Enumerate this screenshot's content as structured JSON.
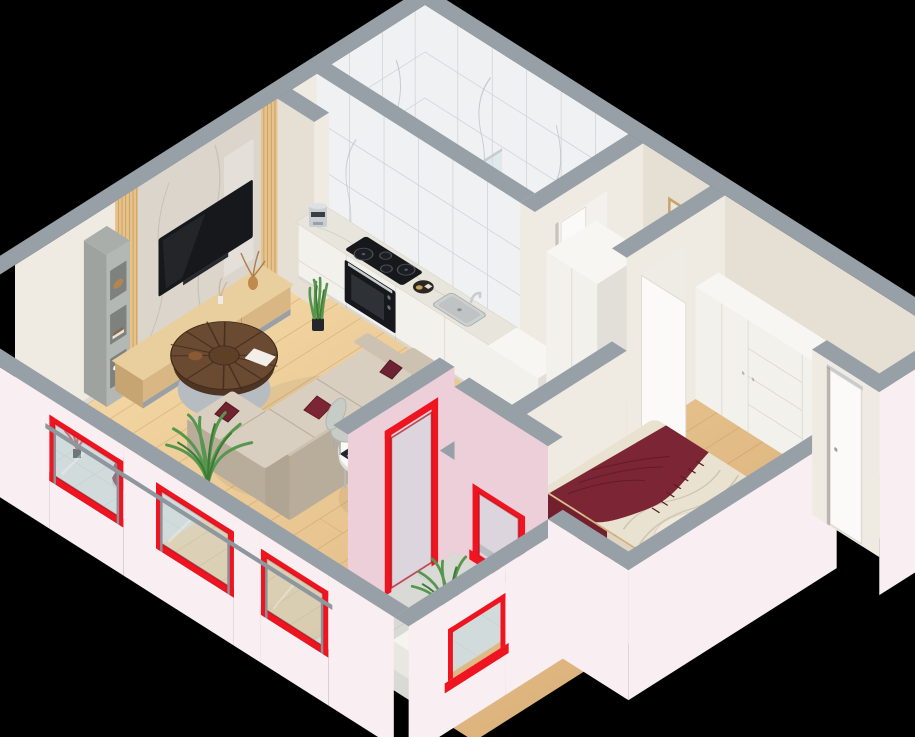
{
  "meta": {
    "type": "3d-floor-plan-render",
    "view": "isometric cutaway, viewed from above on black background",
    "apartment": "one-bedroom apartment with loggia balconies",
    "background": "#000000"
  },
  "palette": {
    "bg": "#000000",
    "wall_cream": "#f0ebe2",
    "wall_cream_dark": "#e5dfd4",
    "wall_cap": "#97a0a7",
    "wall_pink_ext": "#f9eef2",
    "loggia_pink": "#eccfd8",
    "accent_red": "#ee1420",
    "accent_red_dark": "#b30d15",
    "glass_blue": "#c9dde4",
    "rail_gray": "#8e979e",
    "tile_gray": "#d9d9d5",
    "tile_line": "#c3c8cd",
    "marble_light": "#eff1f2",
    "marble_counter": "#e8e5dc",
    "marble_tv": "#dbd5cc",
    "floor_wood_light": "#f2d5a2",
    "floor_wood_dark": "#ddb47e",
    "plank_line": "#b98f59",
    "cabinet_white": "#f3f1ec",
    "cabinet_shadow": "#e2dfd8",
    "wood_slat": "#e7c38c",
    "slat_line": "#c49b60",
    "wood_console": "#d9b785",
    "wood_console_top": "#eacf9e",
    "sofa_beige": "#cdc2b1",
    "sofa_beige_dark": "#b8ac9a",
    "sofa_seat": "#d9cfc0",
    "pillow_burgundy": "#7c2534",
    "bed_linen": "#e9e2d1",
    "walnut": "#6b4a32",
    "walnut_dark": "#4e3423",
    "leg_gray": "#b6bcc0",
    "plant_green": "#57964d",
    "plant_green_dark": "#3c7a36",
    "appliance_black": "#16181c",
    "steel": "#c7ccd1",
    "gold_frame": "#c8a368",
    "table_white": "#fafaf7",
    "chair_gray": "#c8ccc7",
    "tub_white": "#f6f6f4"
  },
  "rooms": [
    {
      "id": "living-room",
      "label": "Living room",
      "items": [
        "wall-mounted TV",
        "marble TV feature panel",
        "wood slat panels",
        "gray shelf unit",
        "wood TV console",
        "round walnut coffee table",
        "L-shaped beige sofa",
        "burgundy cushions",
        "palm plant",
        "snake plant"
      ]
    },
    {
      "id": "dining-area",
      "label": "Dining area",
      "items": [
        "white oval table",
        "two gray shell chairs",
        "black placemats with gold-rim plates",
        "pampas grass vase"
      ]
    },
    {
      "id": "kitchen",
      "label": "Kitchen",
      "items": [
        "white cabinet run",
        "marble worktop",
        "black induction cooktop",
        "built-in black oven",
        "inset sink",
        "chrome faucet",
        "silver coffee machine",
        "round serving tray",
        "white end cabinet",
        "partition stub wall"
      ]
    },
    {
      "id": "bathroom",
      "label": "Bathroom",
      "items": [
        "white marble wall tiles",
        "bathtub",
        "glass shower screen",
        "open white door"
      ]
    },
    {
      "id": "hallway",
      "label": "Hallway",
      "items": [
        "white storage cabinet",
        "duct shaft",
        "entrance door (open)"
      ]
    },
    {
      "id": "bedroom",
      "label": "Bedroom",
      "items": [
        "double bed",
        "beige rumpled bedding",
        "burgundy fringed throw",
        "two pillows",
        "long white wardrobe with drawers",
        "open white door"
      ]
    },
    {
      "id": "loggia",
      "label": "Loggia / balconies",
      "items": [
        "bright red window reveals",
        "tall red-framed balcony door",
        "glass balustrades with gray handrail",
        "gray tile floor",
        "concrete window bench",
        "maroon lounge chair",
        "red-leaf plant",
        "palm plant",
        "white bench unit"
      ]
    }
  ],
  "structure": {
    "exterior_walls": "pale pink plaster with gray cut caps",
    "interior_walls": "cream with gray cut caps",
    "floors": "oak laminate planks; gray tile on balconies; marble in bathroom",
    "accent": "vivid red painted window and door reveals on all facade openings"
  }
}
